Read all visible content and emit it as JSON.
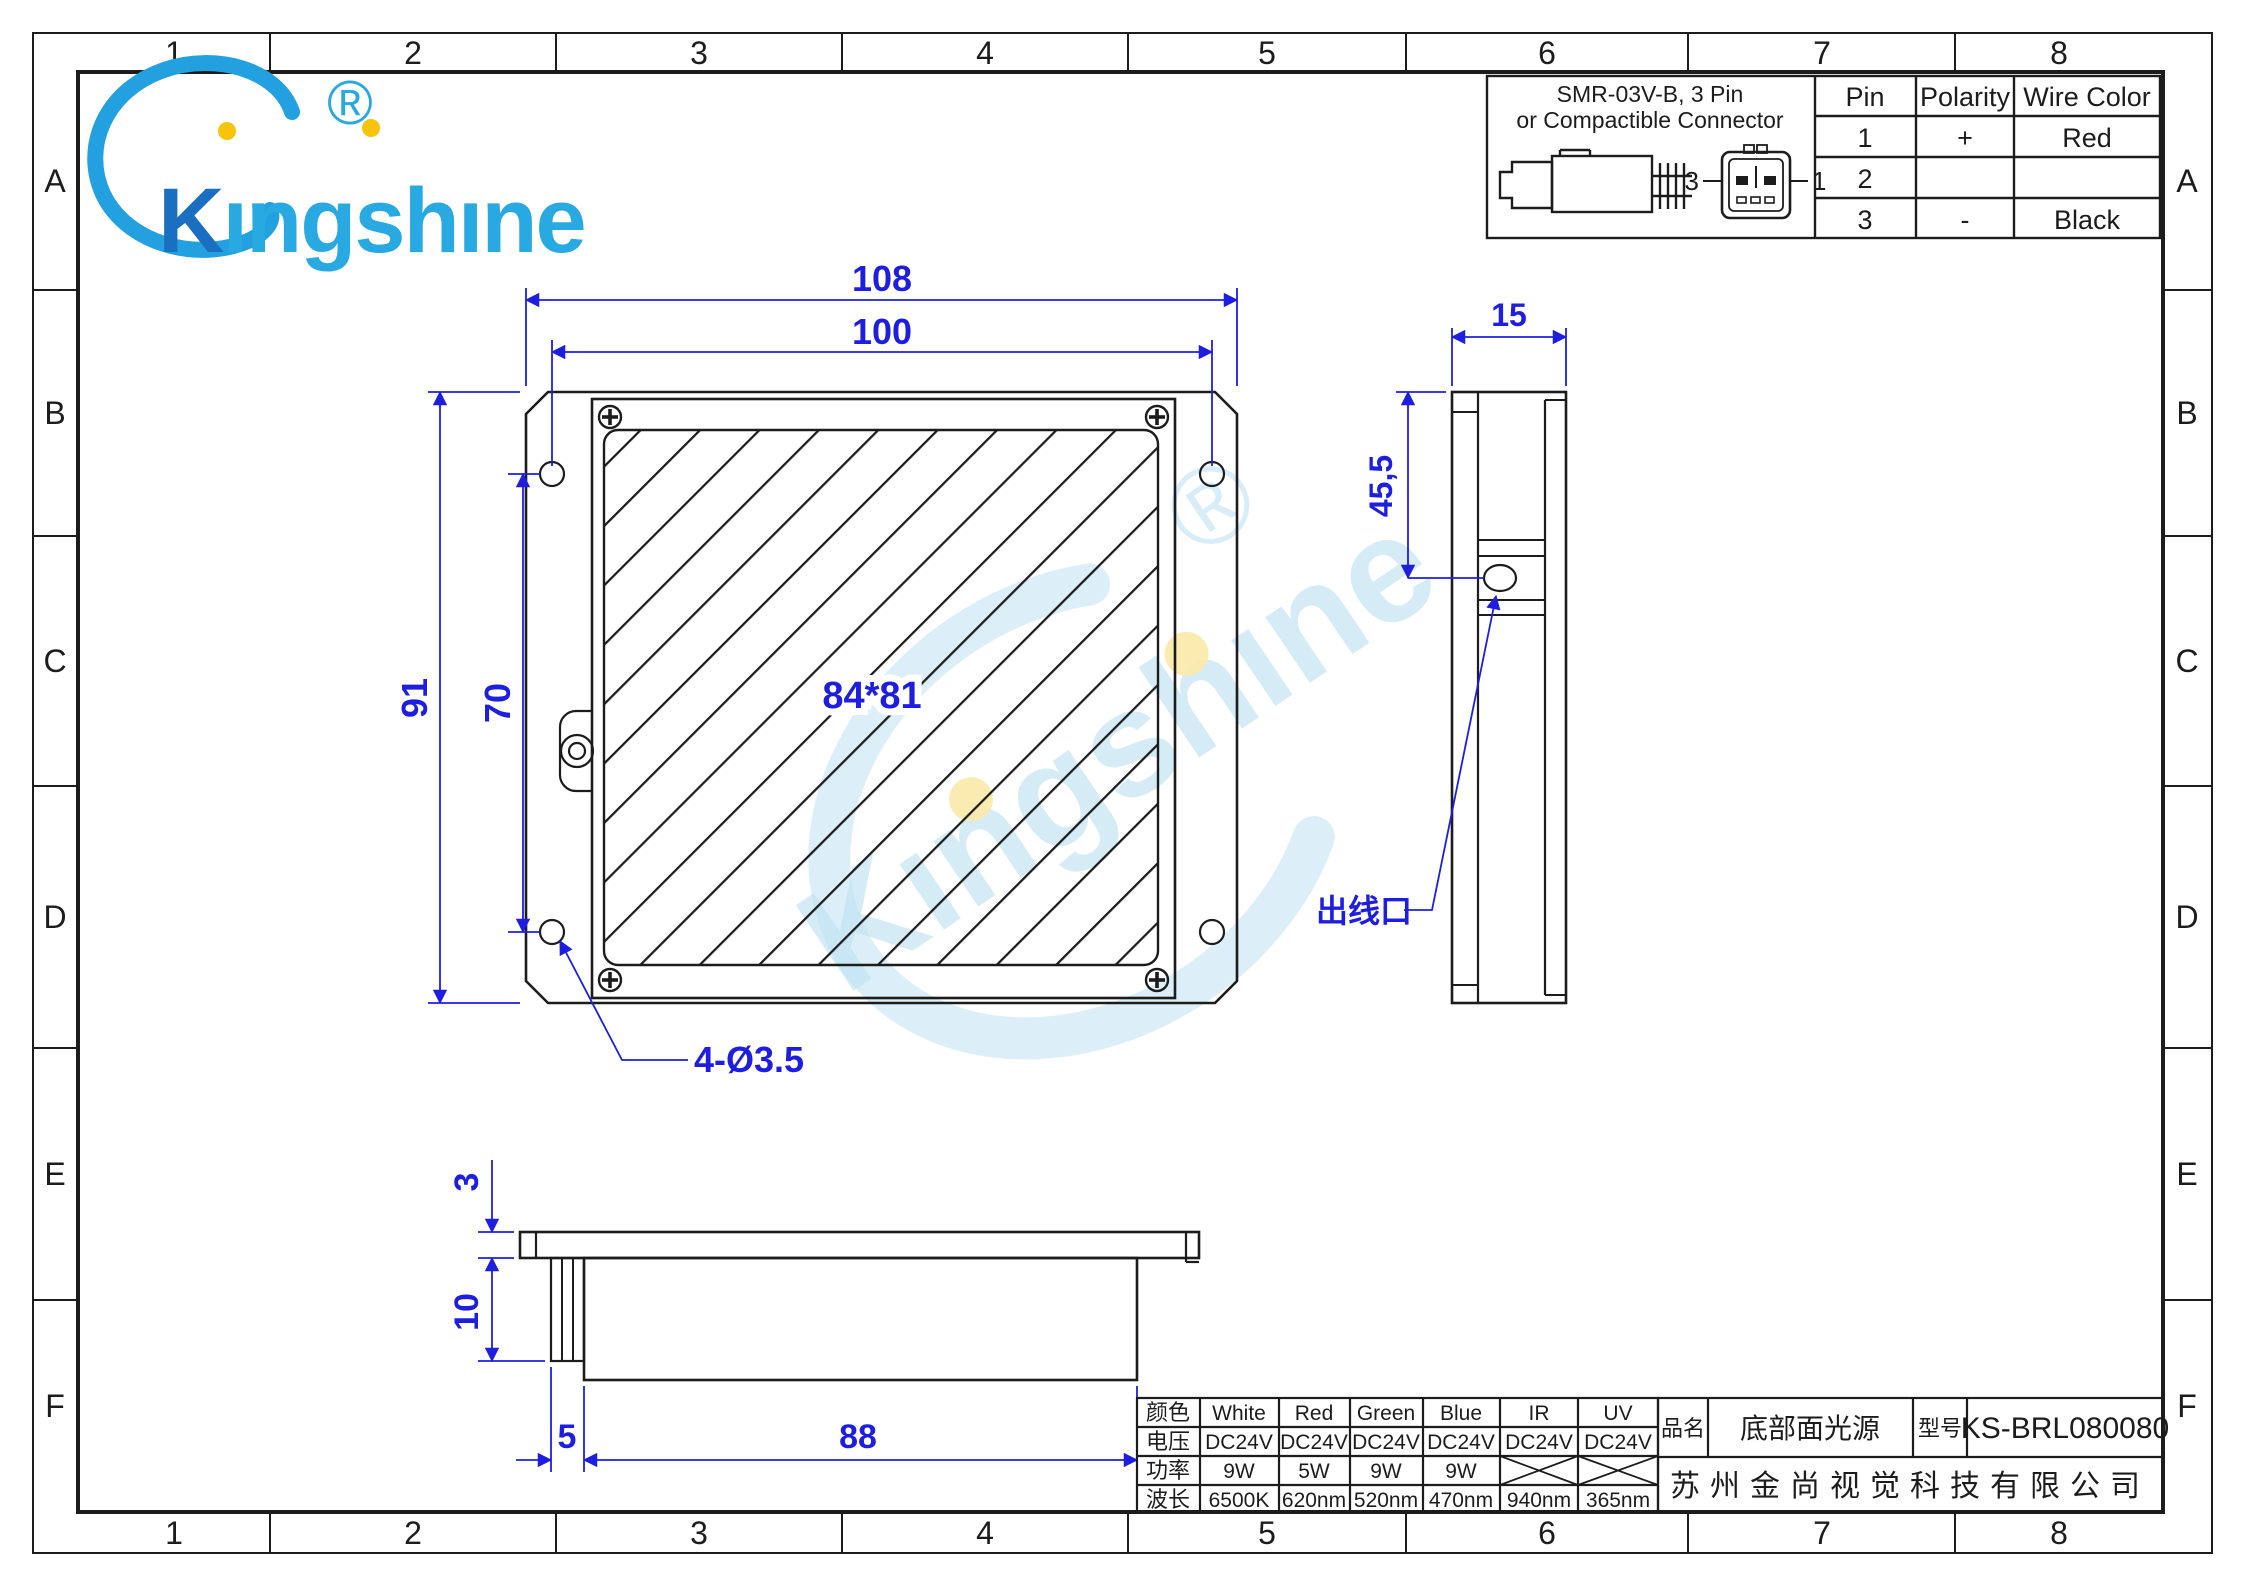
{
  "sheet": {
    "grid_columns": [
      "1",
      "2",
      "3",
      "4",
      "5",
      "6",
      "7",
      "8"
    ],
    "grid_rows": [
      "A",
      "B",
      "C",
      "D",
      "E",
      "F"
    ]
  },
  "logo": {
    "brand": "Kingshine",
    "k": "K",
    "rest": "ıngshıne",
    "registered": "®"
  },
  "connector_box": {
    "title_line1": "SMR-03V-B, 3 Pin",
    "title_line2": "or Compactible Connector",
    "pin_left_label": "3",
    "pin_right_label": "1",
    "pin_table": {
      "headers": [
        "Pin",
        "Polarity",
        "Wire Color"
      ],
      "rows": [
        [
          "1",
          "+",
          "Red"
        ],
        [
          "2",
          "",
          ""
        ],
        [
          "3",
          "-",
          "Black"
        ]
      ]
    }
  },
  "front_view": {
    "dim_outer_width": "108",
    "dim_hole_spacing_h": "100",
    "dim_outer_height": "91",
    "dim_hole_spacing_v": "70",
    "dim_window": "84*81",
    "dim_holes": "4-Ø3.5"
  },
  "side_view": {
    "dim_width": "15",
    "dim_outlet_offset": "45,5",
    "outlet_label": "出线口"
  },
  "bottom_view": {
    "dim_flange": "3",
    "dim_depth": "10",
    "dim_tab": "5",
    "dim_body": "88"
  },
  "spec_table": {
    "row_headers": [
      "颜色",
      "电压",
      "功率",
      "波长"
    ],
    "colors": [
      "White",
      "Red",
      "Green",
      "Blue",
      "IR",
      "UV"
    ],
    "voltages": [
      "DC24V",
      "DC24V",
      "DC24V",
      "DC24V",
      "DC24V",
      "DC24V"
    ],
    "powers": [
      "9W",
      "5W",
      "9W",
      "9W",
      "",
      ""
    ],
    "wavelengths": [
      "6500K",
      "620nm",
      "520nm",
      "470nm",
      "940nm",
      "365nm"
    ]
  },
  "title_block": {
    "name_label": "品名",
    "product_name": "底部面光源",
    "model_label": "型号",
    "model": "KS-BRL080080",
    "company": "苏州金尚视觉科技有限公司"
  },
  "palette": {
    "dimension_blue": "#1e1ee0",
    "line_black": "#1c1c1c",
    "logo_dark_blue": "#1b6fc0",
    "logo_light_blue": "#29a9e1",
    "logo_yellow": "#f6c50b",
    "watermark_blue": "#bfe2f4",
    "watermark_yellow": "#f9e9a9"
  }
}
